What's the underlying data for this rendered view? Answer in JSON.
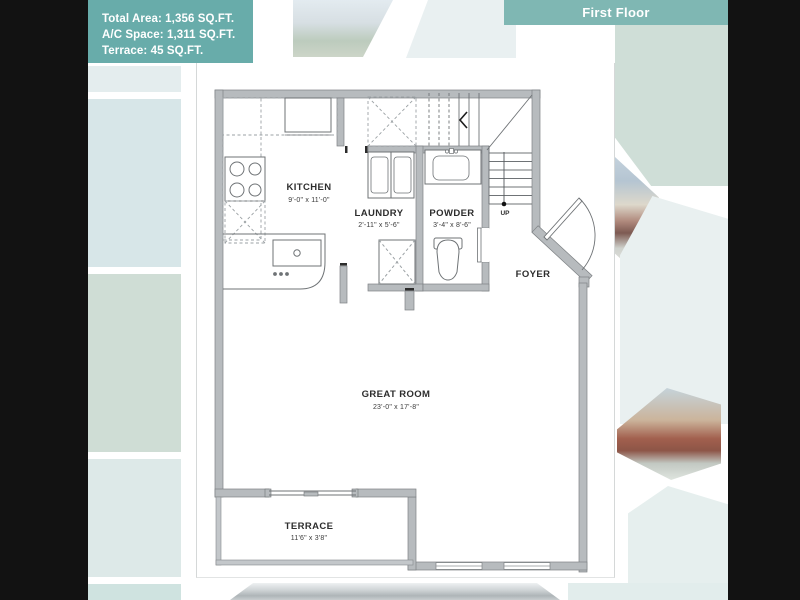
{
  "header": {
    "banner": "First Floor"
  },
  "info_box": {
    "lines": [
      "Total Area: 1,356 SQ.FT.",
      "A/C Space: 1,311 SQ.FT.",
      "Terrace: 45 SQ.FT."
    ]
  },
  "plan": {
    "rooms": [
      {
        "name": "KITCHEN",
        "dims": "9'-0\" x 11'-0\""
      },
      {
        "name": "LAUNDRY",
        "dims": "2'-11\" x 5'-6\""
      },
      {
        "name": "POWDER",
        "dims": "3'-4\" x 8'-6\""
      },
      {
        "name": "FOYER",
        "dims": ""
      },
      {
        "name": "GREAT ROOM",
        "dims": "23'-0\" x 17'-8\""
      },
      {
        "name": "TERRACE",
        "dims": "11'6\" x 3'8\""
      }
    ],
    "stair_label": "UP"
  },
  "colors": {
    "info_box_teal": "#68acaa",
    "banner_teal": "#7fb7b3",
    "wall_grey": "#b7bbbe",
    "hex_sage": "#cfddd5",
    "hex_blue": "#d7e6e8",
    "letterbox_black": "#121212"
  }
}
